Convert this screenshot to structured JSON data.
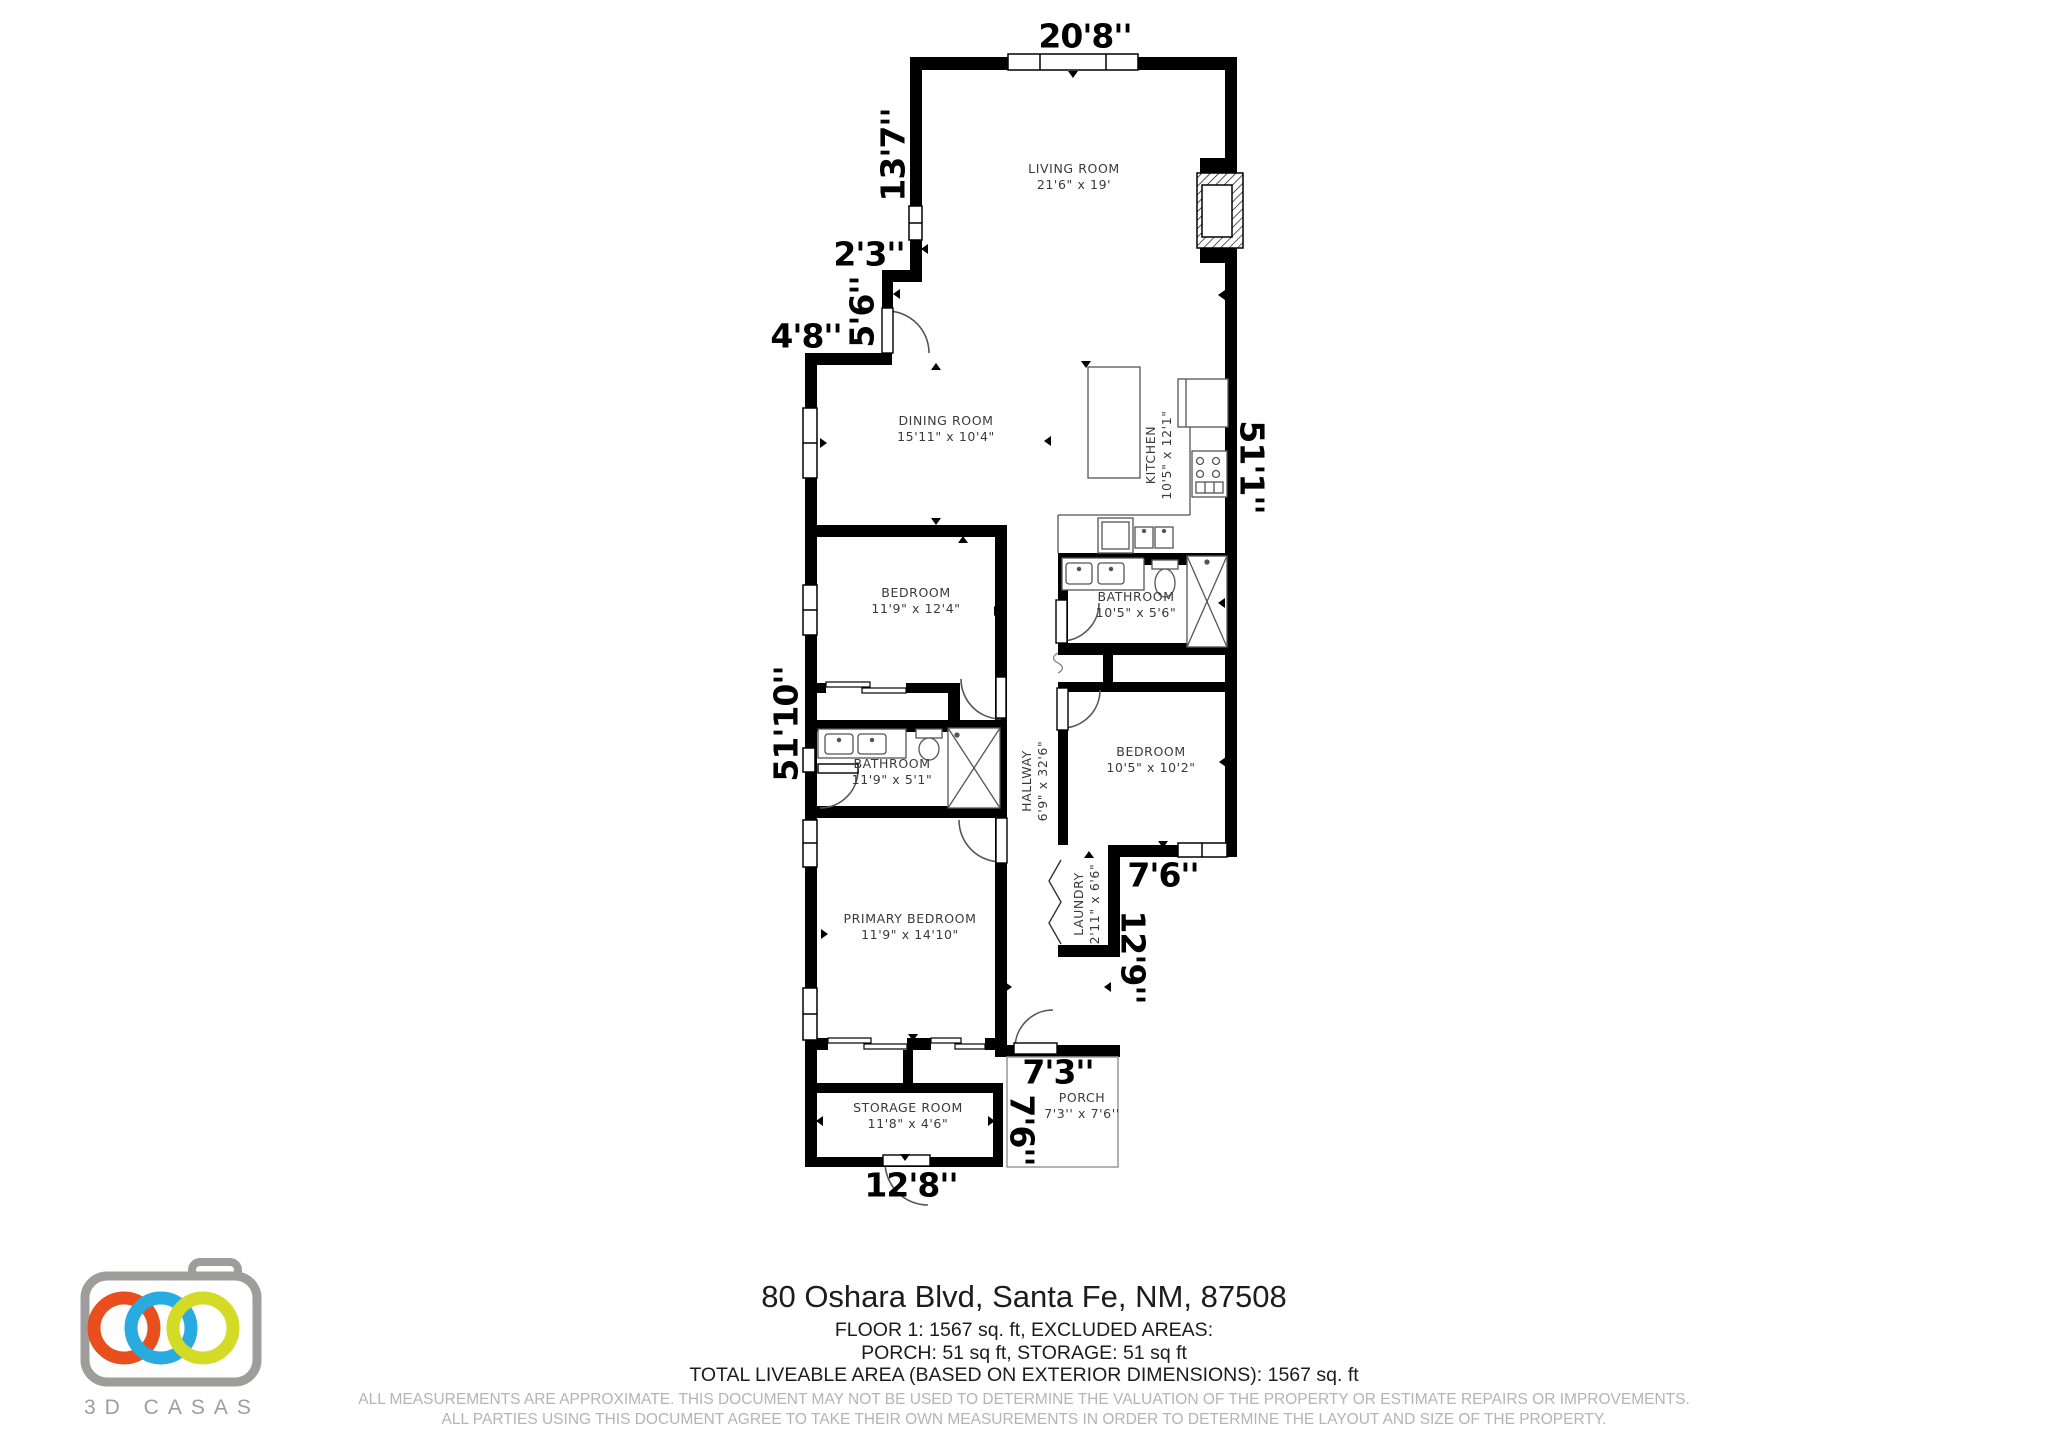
{
  "plan": {
    "rooms": [
      {
        "name": "LIVING ROOM",
        "dims": "21'6\" x 19'",
        "x": 1074,
        "y": 176,
        "rot": 0
      },
      {
        "name": "DINING ROOM",
        "dims": "15'11\" x 10'4\"",
        "x": 946,
        "y": 428,
        "rot": 0
      },
      {
        "name": "KITCHEN",
        "dims": "10'5\" x 12'1\"",
        "x": 1158,
        "y": 455,
        "rot": -90
      },
      {
        "name": "BEDROOM",
        "dims": "11'9\" x 12'4\"",
        "x": 916,
        "y": 600,
        "rot": 0
      },
      {
        "name": "BATHROOM",
        "dims": "11'9\" x 5'1\"",
        "x": 892,
        "y": 771,
        "rot": 0
      },
      {
        "name": "BATHROOM",
        "dims": "10'5\" x 5'6\"",
        "x": 1136,
        "y": 604,
        "rot": 0
      },
      {
        "name": "BEDROOM",
        "dims": "10'5\" x 10'2\"",
        "x": 1151,
        "y": 759,
        "rot": 0
      },
      {
        "name": "HALLWAY",
        "dims": "6'9\" x 32'6\"",
        "x": 1034,
        "y": 781,
        "rot": -90
      },
      {
        "name": "LAUNDRY",
        "dims": "2'11\" x 6'6\"",
        "x": 1086,
        "y": 904,
        "rot": -90
      },
      {
        "name": "PRIMARY BEDROOM",
        "dims": "11'9\" x 14'10\"",
        "x": 910,
        "y": 926,
        "rot": 0
      },
      {
        "name": "STORAGE ROOM",
        "dims": "11'8\" x 4'6\"",
        "x": 908,
        "y": 1115,
        "rot": 0
      },
      {
        "name": "PORCH",
        "dims": "7'3'' x 7'6''",
        "x": 1082,
        "y": 1105,
        "rot": 0
      }
    ],
    "outer_dims": [
      {
        "v": "20'8''",
        "x": 1085,
        "y": 36,
        "rot": 0
      },
      {
        "v": "13'7''",
        "x": 893,
        "y": 155,
        "rot": -90
      },
      {
        "v": "2'3''",
        "x": 869,
        "y": 254,
        "rot": 0
      },
      {
        "v": "5'6''",
        "x": 862,
        "y": 312,
        "rot": -90
      },
      {
        "v": "4'8''",
        "x": 806,
        "y": 336,
        "rot": 0
      },
      {
        "v": "51'1''",
        "x": 1252,
        "y": 467,
        "rot": 90
      },
      {
        "v": "51'10''",
        "x": 786,
        "y": 724,
        "rot": -90
      },
      {
        "v": "7'6''",
        "x": 1163,
        "y": 875,
        "rot": 0
      },
      {
        "v": "12'9''",
        "x": 1133,
        "y": 957,
        "rot": 90
      },
      {
        "v": "7'3''",
        "x": 1058,
        "y": 1072,
        "rot": 0
      },
      {
        "v": "7'6''",
        "x": 1022,
        "y": 1130,
        "rot": 90
      },
      {
        "v": "12'8''",
        "x": 911,
        "y": 1185,
        "rot": 0
      }
    ],
    "ticks": [
      {
        "x": 1073,
        "y": 74,
        "d": "down"
      },
      {
        "x": 925,
        "y": 249,
        "d": "left"
      },
      {
        "x": 897,
        "y": 294,
        "d": "left"
      },
      {
        "x": 936,
        "y": 367,
        "d": "up"
      },
      {
        "x": 823,
        "y": 443,
        "d": "right"
      },
      {
        "x": 1222,
        "y": 295,
        "d": "left"
      },
      {
        "x": 1086,
        "y": 364,
        "d": "down"
      },
      {
        "x": 1048,
        "y": 441,
        "d": "left"
      },
      {
        "x": 936,
        "y": 521,
        "d": "down"
      },
      {
        "x": 963,
        "y": 540,
        "d": "up"
      },
      {
        "x": 1146,
        "y": 557,
        "d": "down"
      },
      {
        "x": 1222,
        "y": 603,
        "d": "left"
      },
      {
        "x": 997,
        "y": 611,
        "d": "right"
      },
      {
        "x": 1223,
        "y": 762,
        "d": "left"
      },
      {
        "x": 1163,
        "y": 844,
        "d": "down"
      },
      {
        "x": 1089,
        "y": 855,
        "d": "up"
      },
      {
        "x": 824,
        "y": 934,
        "d": "right"
      },
      {
        "x": 913,
        "y": 1037,
        "d": "down"
      },
      {
        "x": 1008,
        "y": 987,
        "d": "right"
      },
      {
        "x": 1108,
        "y": 987,
        "d": "left"
      },
      {
        "x": 905,
        "y": 1157,
        "d": "down"
      },
      {
        "x": 820,
        "y": 1121,
        "d": "left"
      },
      {
        "x": 991,
        "y": 1121,
        "d": "right"
      },
      {
        "x": 1089,
        "y": 948,
        "d": "down"
      }
    ]
  },
  "footer": {
    "address": "80 Oshara Blvd, Santa Fe, NM, 87508",
    "line1": "FLOOR 1: 1567 sq. ft, EXCLUDED AREAS:",
    "line2": "PORCH: 51 sq ft, STORAGE: 51 sq ft",
    "line3": "TOTAL LIVEABLE AREA (BASED ON EXTERIOR DIMENSIONS): 1567 sq. ft",
    "disclaimer1": "ALL MEASUREMENTS ARE APPROXIMATE. THIS DOCUMENT MAY NOT BE USED TO DETERMINE THE VALUATION OF THE PROPERTY OR ESTIMATE REPAIRS OR IMPROVEMENTS.",
    "disclaimer2": "ALL PARTIES USING THIS DOCUMENT AGREE TO TAKE THEIR OWN MEASUREMENTS IN ORDER TO DETERMINE THE LAYOUT AND SIZE OF THE PROPERTY."
  },
  "logo": {
    "brand": "3D CASAS",
    "camera_color": "#9d9d9c",
    "ring_orange": "#E94F1D",
    "ring_blue": "#29ABE2",
    "ring_green": "#D3DB26"
  }
}
